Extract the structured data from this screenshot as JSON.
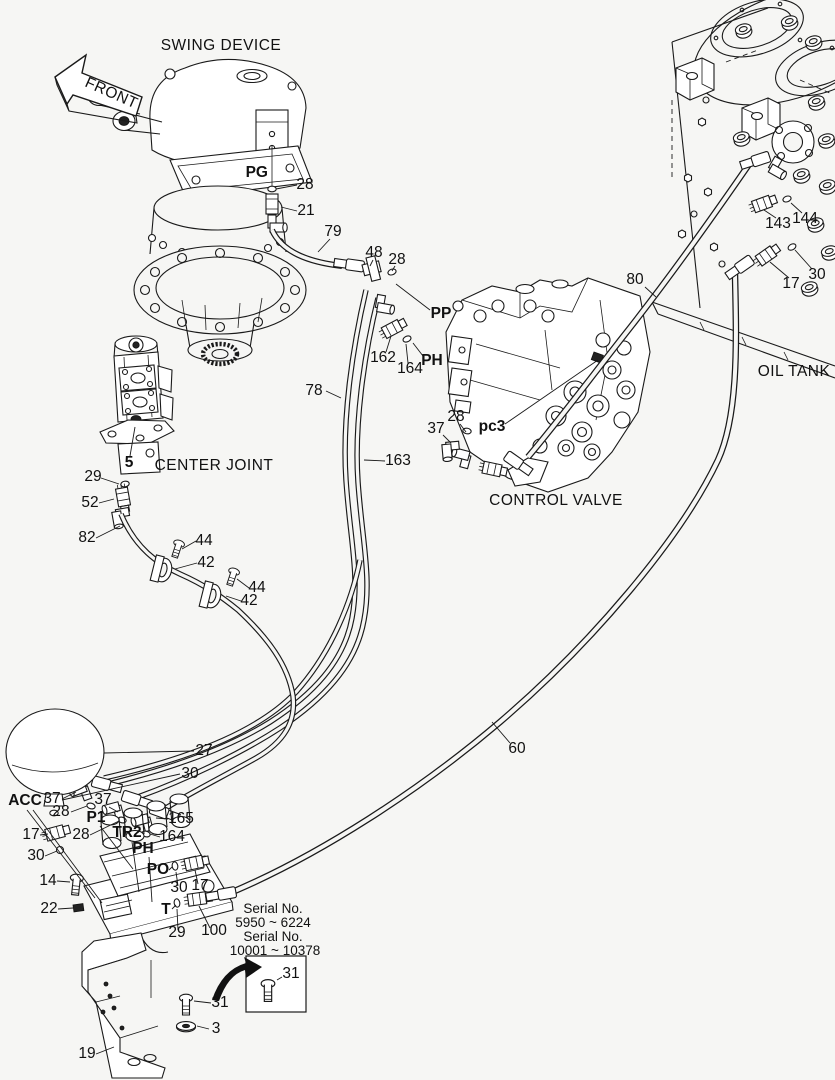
{
  "meta": {
    "document_type": "hydraulic piping parts diagram",
    "background_color": "#f6f6f4",
    "line_color": "#1a1a1a",
    "text_color": "#111111"
  },
  "component_titles": [
    "SWING DEVICE",
    "CENTER JOINT",
    "CONTROL VALVE",
    "OIL TANK"
  ],
  "front_arrow": {
    "label": "FRONT"
  },
  "serial_note": {
    "lines": [
      "Serial No.",
      "5950 ~ 6224",
      "Serial No.",
      "10001 ~ 10378"
    ]
  },
  "port_labels": [
    "PG",
    "PP",
    "PH",
    "pc3",
    "ACC",
    "P1",
    "TR2",
    "PH",
    "PO",
    "T"
  ],
  "part_numbers": [
    "3",
    "5",
    "14",
    "17",
    "19",
    "21",
    "22",
    "27",
    "28",
    "29",
    "30",
    "31",
    "37",
    "42",
    "44",
    "48",
    "52",
    "60",
    "78",
    "79",
    "80",
    "82",
    "100",
    "143",
    "144",
    "162",
    "163",
    "164",
    "165"
  ],
  "labels": [
    {
      "t": "SWING DEVICE",
      "x": 221,
      "y": 50,
      "s": 15.5,
      "k": "title"
    },
    {
      "t": "FRONT",
      "x": 84,
      "y": 86,
      "s": 15.5,
      "rot": 24,
      "a": "start",
      "k": "title"
    },
    {
      "t": "PG",
      "x": 268,
      "y": 177,
      "b": 1,
      "a": "end",
      "k": "port"
    },
    {
      "t": "28",
      "x": 305,
      "y": 189
    },
    {
      "t": "21",
      "x": 306,
      "y": 215
    },
    {
      "t": "79",
      "x": 333,
      "y": 236
    },
    {
      "t": "48",
      "x": 374,
      "y": 257
    },
    {
      "t": "28",
      "x": 397,
      "y": 264
    },
    {
      "t": "PP",
      "x": 441,
      "y": 318,
      "b": 1,
      "k": "port"
    },
    {
      "t": "162",
      "x": 383,
      "y": 362
    },
    {
      "t": "164",
      "x": 410,
      "y": 373
    },
    {
      "t": "PH",
      "x": 432,
      "y": 365,
      "b": 1,
      "k": "port"
    },
    {
      "t": "78",
      "x": 314,
      "y": 395
    },
    {
      "t": "163",
      "x": 398,
      "y": 465
    },
    {
      "t": "80",
      "x": 635,
      "y": 284
    },
    {
      "t": "143",
      "x": 778,
      "y": 228
    },
    {
      "t": "144",
      "x": 805,
      "y": 223
    },
    {
      "t": "17",
      "x": 791,
      "y": 288
    },
    {
      "t": "30",
      "x": 817,
      "y": 279
    },
    {
      "t": "OIL TANK",
      "x": 794,
      "y": 376,
      "s": 15.5,
      "k": "title"
    },
    {
      "t": "CONTROL VALVE",
      "x": 556,
      "y": 505,
      "s": 15.5,
      "k": "title"
    },
    {
      "t": "pc3",
      "x": 492,
      "y": 431,
      "b": 1,
      "k": "port"
    },
    {
      "t": "37",
      "x": 436,
      "y": 433
    },
    {
      "t": "28",
      "x": 456,
      "y": 421
    },
    {
      "t": "CENTER JOINT",
      "x": 214,
      "y": 470,
      "s": 15.5,
      "k": "title"
    },
    {
      "t": "5",
      "x": 129,
      "y": 467,
      "b": 1
    },
    {
      "t": "29",
      "x": 93,
      "y": 481
    },
    {
      "t": "52",
      "x": 90,
      "y": 507
    },
    {
      "t": "82",
      "x": 87,
      "y": 542
    },
    {
      "t": "44",
      "x": 204,
      "y": 545
    },
    {
      "t": "42",
      "x": 206,
      "y": 567
    },
    {
      "t": "44",
      "x": 257,
      "y": 592
    },
    {
      "t": "42",
      "x": 249,
      "y": 605
    },
    {
      "t": "60",
      "x": 517,
      "y": 753
    },
    {
      "t": "27",
      "x": 204,
      "y": 755
    },
    {
      "t": "30",
      "x": 190,
      "y": 778
    },
    {
      "t": "ACC",
      "x": 25,
      "y": 805,
      "b": 1,
      "k": "port"
    },
    {
      "t": "37",
      "x": 52,
      "y": 803
    },
    {
      "t": "28",
      "x": 61,
      "y": 816
    },
    {
      "t": "37",
      "x": 103,
      "y": 804
    },
    {
      "t": "P1",
      "x": 96,
      "y": 822,
      "b": 1,
      "k": "port"
    },
    {
      "t": "28",
      "x": 81,
      "y": 839
    },
    {
      "t": "TR2",
      "x": 127,
      "y": 837,
      "b": 1,
      "k": "port"
    },
    {
      "t": "17",
      "x": 31,
      "y": 839
    },
    {
      "t": "30",
      "x": 36,
      "y": 860
    },
    {
      "t": "PH",
      "x": 143,
      "y": 853,
      "b": 1,
      "k": "port"
    },
    {
      "t": "165",
      "x": 181,
      "y": 823
    },
    {
      "t": "164",
      "x": 172,
      "y": 841
    },
    {
      "t": "PO",
      "x": 158,
      "y": 874,
      "b": 1,
      "k": "port"
    },
    {
      "t": "30",
      "x": 179,
      "y": 892
    },
    {
      "t": "17",
      "x": 200,
      "y": 890
    },
    {
      "t": "14",
      "x": 48,
      "y": 885
    },
    {
      "t": "22",
      "x": 49,
      "y": 913
    },
    {
      "t": "T",
      "x": 166,
      "y": 914,
      "b": 1,
      "k": "port"
    },
    {
      "t": "29",
      "x": 177,
      "y": 937
    },
    {
      "t": "100",
      "x": 214,
      "y": 935
    },
    {
      "t": "Serial No.",
      "x": 273,
      "y": 913,
      "s": 13.5,
      "k": "serial"
    },
    {
      "t": "5950 ~ 6224",
      "x": 273,
      "y": 927,
      "s": 13.5,
      "k": "serial"
    },
    {
      "t": "Serial No.",
      "x": 273,
      "y": 941,
      "s": 13.5,
      "k": "serial"
    },
    {
      "t": "10001 ~ 10378",
      "x": 275,
      "y": 955,
      "s": 13.5,
      "k": "serial"
    },
    {
      "t": "31",
      "x": 291,
      "y": 978
    },
    {
      "t": "31",
      "x": 220,
      "y": 1007
    },
    {
      "t": "3",
      "x": 216,
      "y": 1033
    },
    {
      "t": "19",
      "x": 87,
      "y": 1058
    }
  ]
}
